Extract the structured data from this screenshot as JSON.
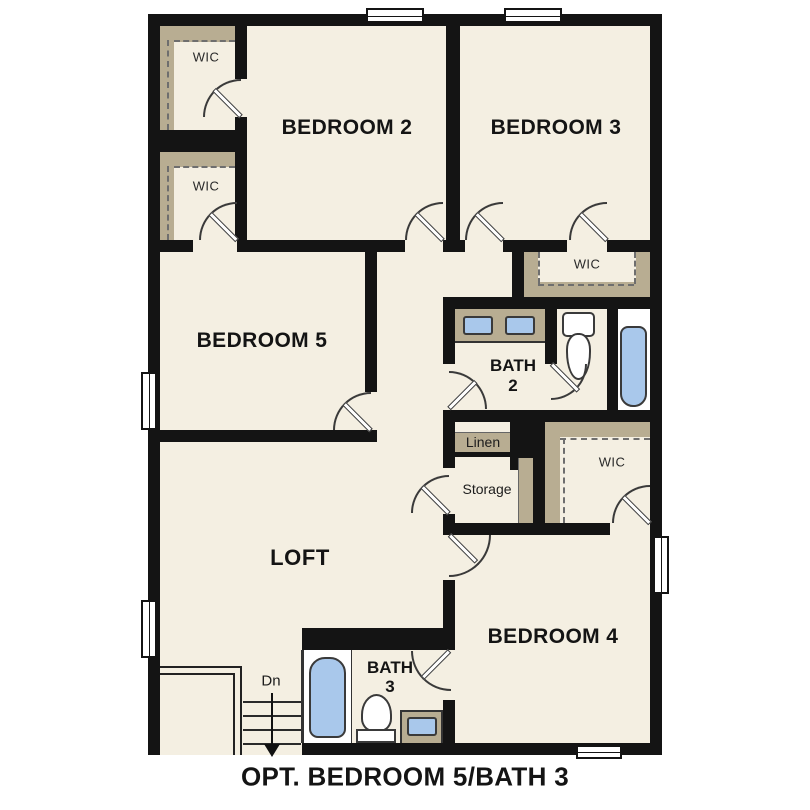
{
  "floor_plan": {
    "caption": "OPT. BEDROOM 5/BATH 3",
    "labels": {
      "bedroom2": "BEDROOM 2",
      "bedroom3": "BEDROOM 3",
      "bedroom5": "BEDROOM 5",
      "bedroom4": "BEDROOM 4",
      "loft": "LOFT",
      "bath2_line1": "BATH",
      "bath2_line2": "2",
      "bath3_line1": "BATH",
      "bath3_line2": "3",
      "wic_top_left": "WIC",
      "wic_mid_left": "WIC",
      "wic_right_upper": "WIC",
      "wic_right_lower": "WIC",
      "linen": "Linen",
      "storage": "Storage",
      "stairs_down": "Dn"
    },
    "colors": {
      "floor": "#f4efe2",
      "wall": "#141414",
      "closet_shelf_tan": "#b8ad92",
      "fixture_blue": "#a9c8eb"
    }
  }
}
